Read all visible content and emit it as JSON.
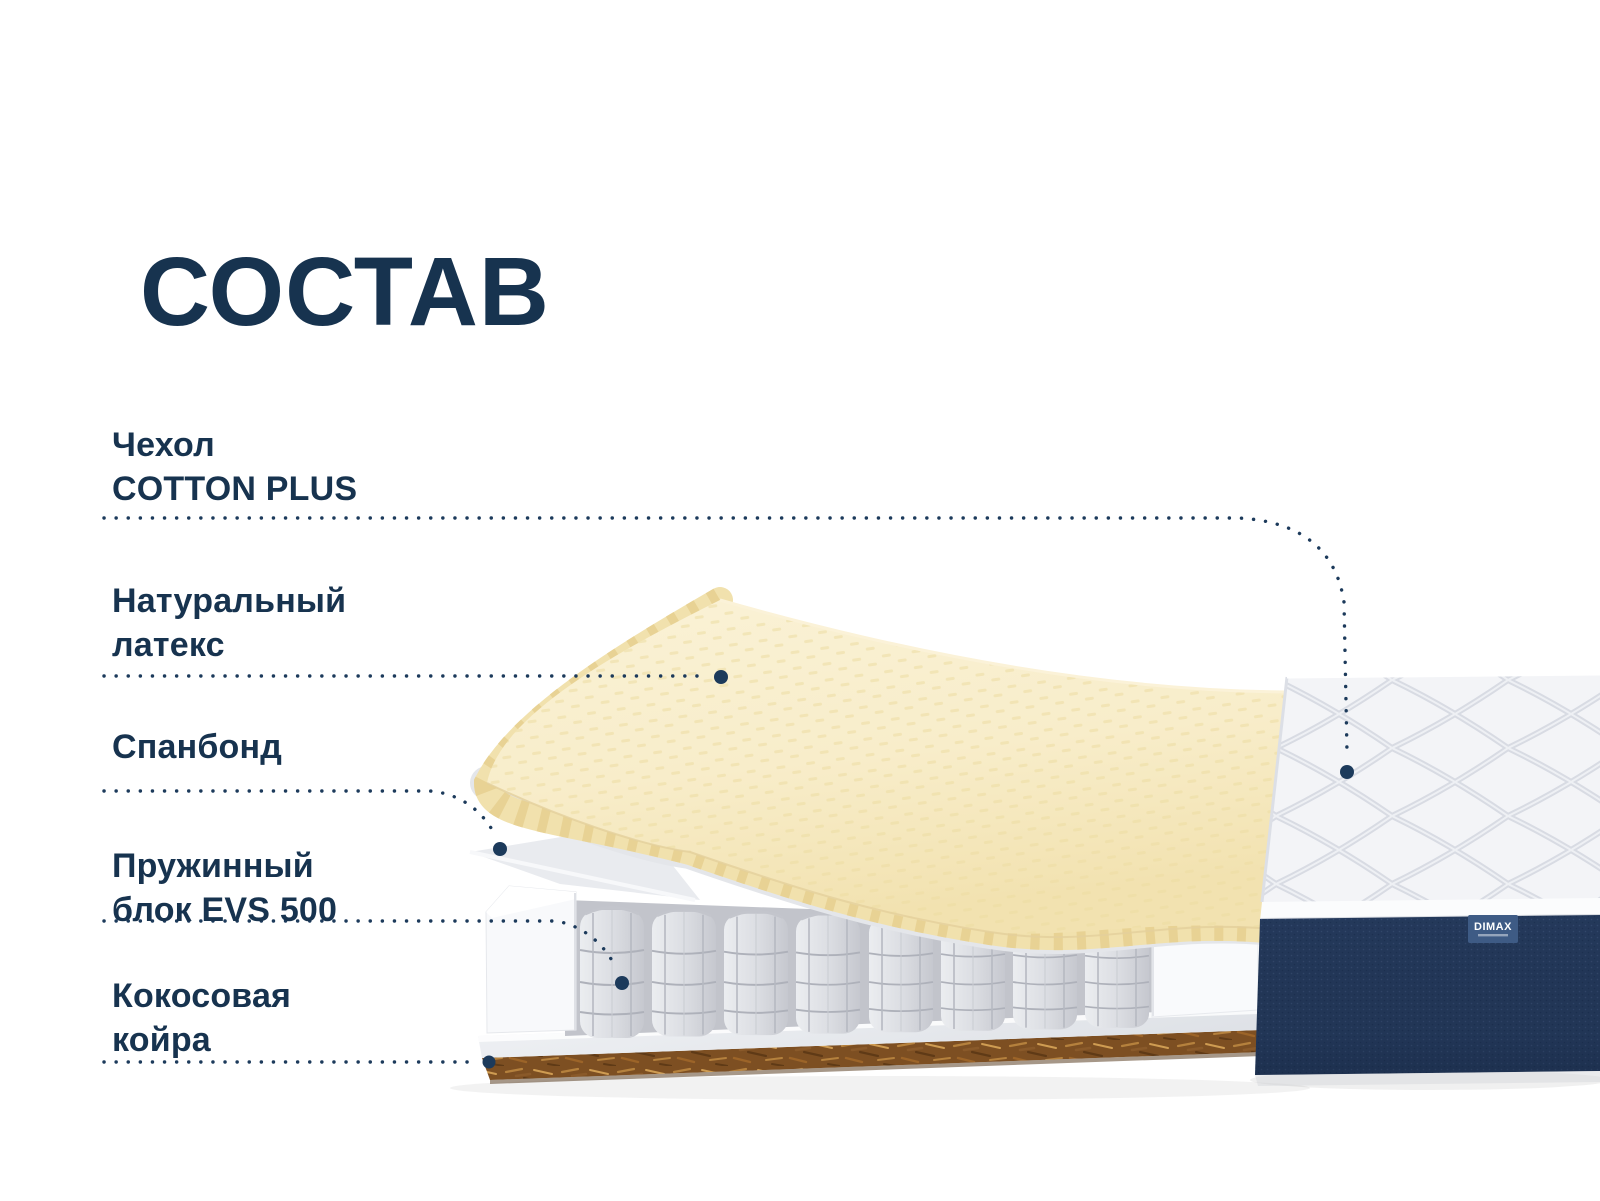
{
  "title": "СОСТАВ",
  "labels": {
    "cover": {
      "line1": "Чехол",
      "line2": "COTTON PLUS"
    },
    "latex": {
      "line1": "Натуральный",
      "line2": "латекс"
    },
    "spunbond": {
      "line1": "Спанбонд",
      "line2": ""
    },
    "springs": {
      "line1": "Пружинный",
      "line2": "блок EVS 500"
    },
    "coir": {
      "line1": "Кокосовая",
      "line2": "койра"
    }
  },
  "brand": {
    "tag_label": "DIMAX"
  },
  "colors": {
    "text_navy": "#17334f",
    "leader_line": "#1c3a5b",
    "latex_cream": "#f8edca",
    "latex_rib": "#e8d294",
    "spunbond_gray": "#e7e9ed",
    "spring_gray": "#d9dade",
    "coir_brown": "#7d4f22",
    "side_navy": "#24395b",
    "brand_tag_blue": "#3e5b85",
    "quilt_white": "#f3f4f7"
  }
}
